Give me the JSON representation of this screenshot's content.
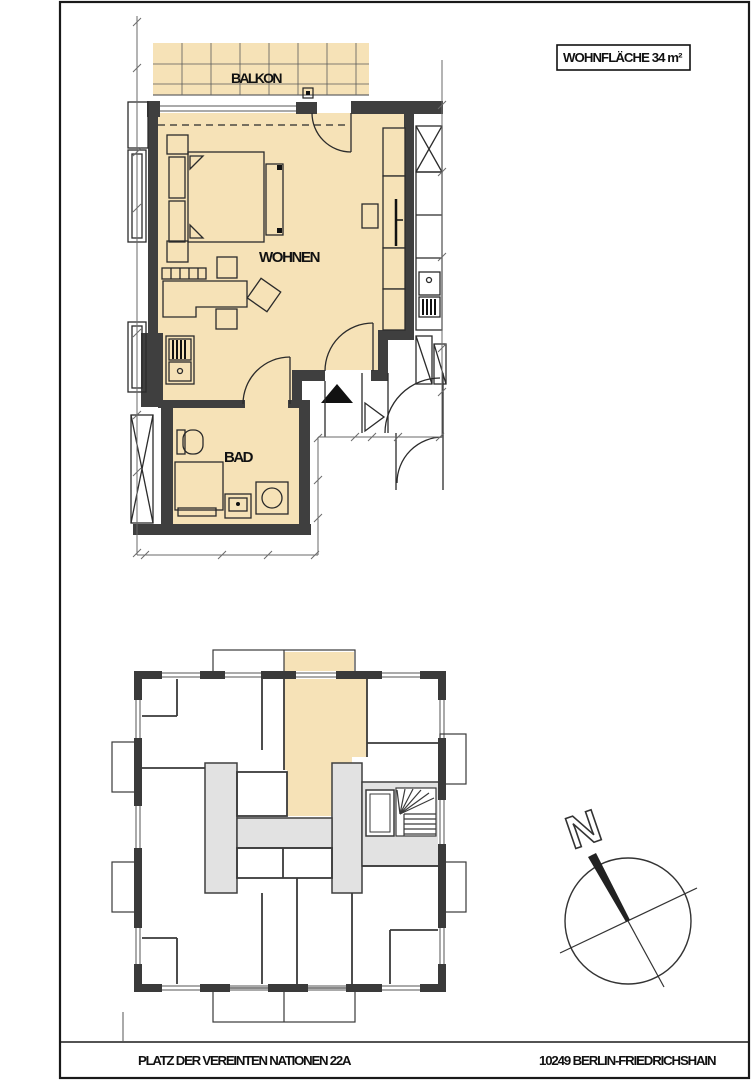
{
  "area_label": {
    "text": "WOHNFLÄCHE 34 m²"
  },
  "rooms": {
    "balcony": "BALKON",
    "living": "WOHNEN",
    "bath": "BAD"
  },
  "compass": {
    "north": "N"
  },
  "footer": {
    "address": "PLATZ DER VEREINTEN NATIONEN 22A",
    "city": "10249 BERLIN-FRIEDRICHSHAIN"
  },
  "colors": {
    "unit_fill": "#f6e2b7",
    "wall": "#3f3f3f",
    "corridor": "#e2e2e2",
    "line": "#2b2b2b",
    "frame": "#1a1a1a"
  }
}
